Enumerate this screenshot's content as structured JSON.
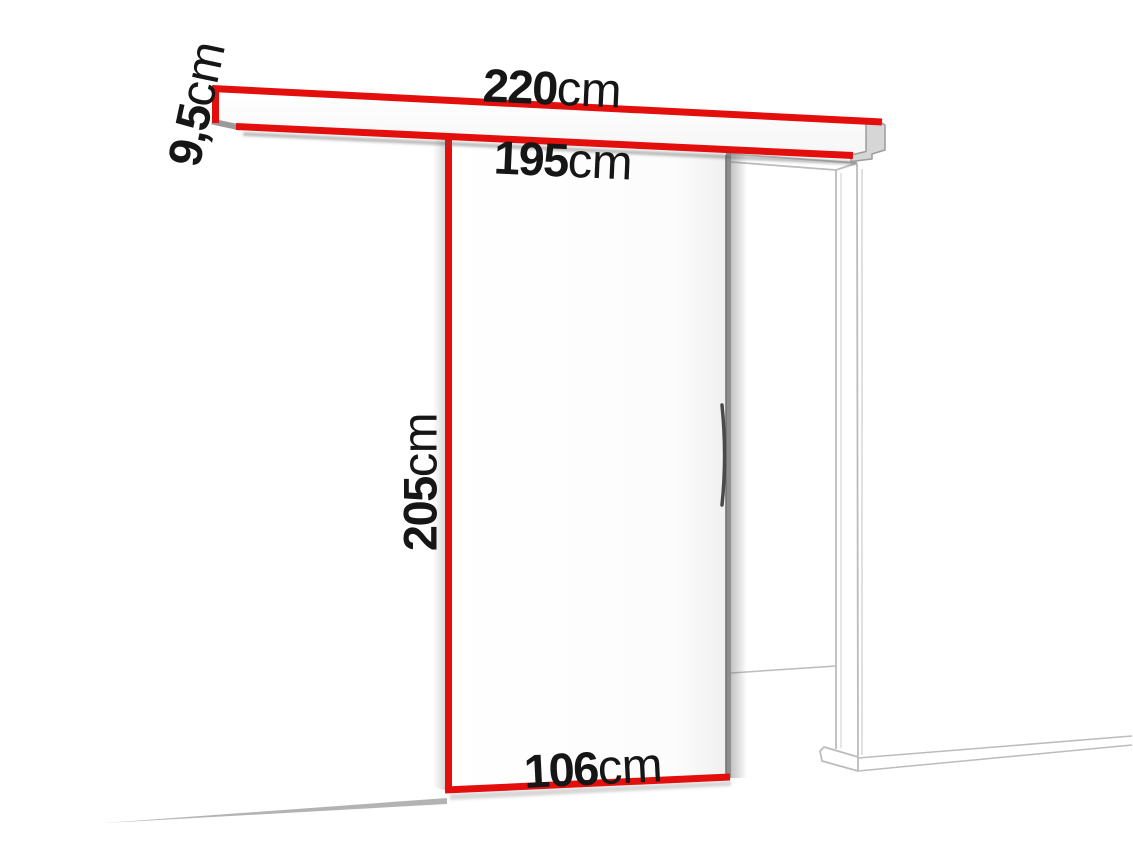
{
  "diagram": {
    "name": "sliding-door-system-dimension-diagram",
    "measurements": {
      "track_total_length": {
        "value": "220",
        "unit": "cm"
      },
      "track_profile_height": {
        "value": "9,5",
        "unit": "cm"
      },
      "track_inner_length": {
        "value": "195",
        "unit": "cm"
      },
      "door_height": {
        "value": "205",
        "unit": "cm"
      },
      "door_width": {
        "value": "106",
        "unit": "cm"
      }
    },
    "colors": {
      "highlight": "#e30f0c",
      "text": "#161616",
      "background": "#ffffff",
      "frame-line": "#bcbcbc",
      "frame-line-light": "#d4d4d4",
      "dark-edge": "#8e8e8e",
      "cap-fill": "#d6d6d6",
      "cap-stroke": "#9c9c9c",
      "floor-line": "#b3b3b3"
    }
  }
}
